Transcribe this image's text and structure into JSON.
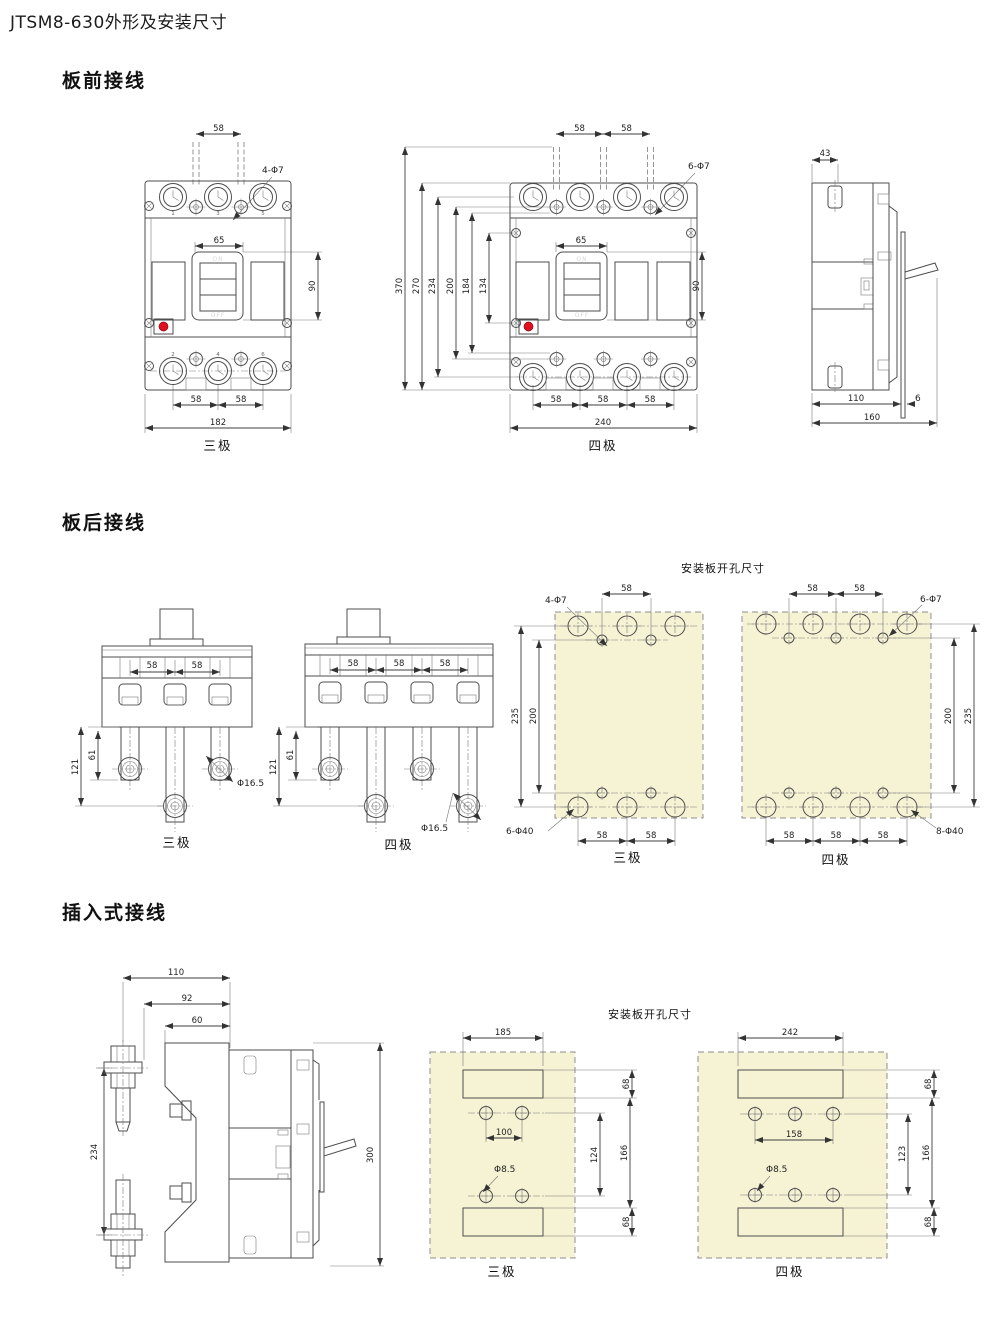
{
  "page_title": "JTSM8-630外形及安装尺寸",
  "sections": {
    "front": "板前接线",
    "rear": "板后接线",
    "plugin": "插入式接线"
  },
  "common": {
    "pole3": "三极",
    "pole4": "四极",
    "plate_title": "安装板开孔尺寸",
    "off": "OFF",
    "on": "ON"
  },
  "front3": {
    "top_pitch": "58",
    "hole_note": "4-Φ7",
    "handle_w": "65",
    "handle_h": "90",
    "top_terms": [
      "1",
      "3",
      "5"
    ],
    "bot_terms": [
      "2",
      "4",
      "6"
    ],
    "bot_pitches": [
      "58",
      "58"
    ],
    "width": "182"
  },
  "front4": {
    "top_pitches": [
      "58",
      "58"
    ],
    "hole_note": "6-Φ7",
    "heights": [
      "370",
      "270",
      "234",
      "200",
      "184",
      "134"
    ],
    "handle_w": "65",
    "handle_h": "90",
    "bot_pitches": [
      "58",
      "58",
      "58"
    ],
    "width": "240"
  },
  "side": {
    "top_w": "43",
    "depth_a": "110",
    "depth_b": "6",
    "depth": "160"
  },
  "rear3": {
    "pitches": [
      "58",
      "58"
    ],
    "len_a": "61",
    "len_b": "121",
    "hole_note": "Φ16.5"
  },
  "rear4": {
    "pitches": [
      "58",
      "58",
      "58"
    ],
    "len_a": "61",
    "len_b": "121",
    "hole_note": "Φ16.5"
  },
  "rear_plate3": {
    "top_pitch": "58",
    "hole_note_top": "4-Φ7",
    "v1": "235",
    "v2": "200",
    "hole_note_bot": "6-Φ40",
    "bot_pitches": [
      "58",
      "58"
    ]
  },
  "rear_plate4": {
    "top_pitches": [
      "58",
      "58"
    ],
    "hole_note_top": "6-Φ7",
    "v1": "200",
    "v2": "235",
    "hole_note_bot": "8-Φ40",
    "bot_pitches": [
      "58",
      "58",
      "58"
    ]
  },
  "plug_side": {
    "d110": "110",
    "d92": "92",
    "d60": "60",
    "d234": "234",
    "d300": "300"
  },
  "plug_plate3": {
    "slot_w": "185",
    "slot_h_top": "68",
    "hole_pitch": "100",
    "v1": "124",
    "v2": "166",
    "hole_note": "Φ8.5",
    "slot_h_bot": "68"
  },
  "plug_plate4": {
    "slot_w": "242",
    "slot_h_top": "68",
    "hole_pitch": "158",
    "v1": "123",
    "v2": "166",
    "hole_note": "Φ8.5",
    "slot_h_bot": "68"
  }
}
